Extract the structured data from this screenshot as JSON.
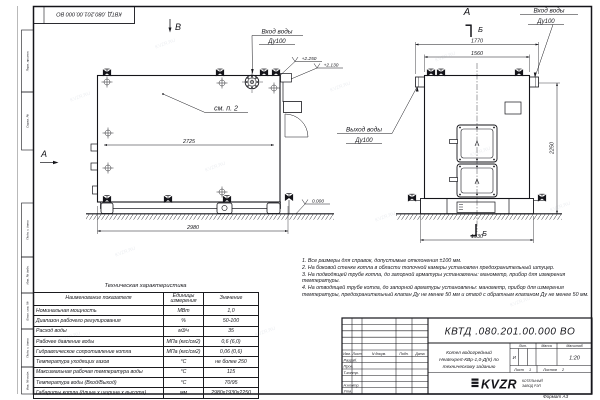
{
  "stamp_top": "КВТД .080.201.00.000 ВО",
  "watermark": "KVZR.RU",
  "margin": {
    "labels": [
      "Перв. примен.",
      "Справ. №",
      "Подп. и дата",
      "Инв. № дубл.",
      "Взам. инв. №",
      "Подп. и дата",
      "Инв. № подл."
    ]
  },
  "side": {
    "view_b": "В",
    "marker_a": "А",
    "inlet_line1": "Вход воды",
    "inlet_line2": "Ду100",
    "see_note": "см. п. 2",
    "elev_top": "+2.250",
    "elev_mid": "+2.130",
    "elev_zero": "0.000",
    "dim_inner": "2725",
    "dim_bottom": "2980"
  },
  "front": {
    "title": "А",
    "section": "Б",
    "inlet_line1": "Вход воды",
    "inlet_line2": "Ду100",
    "outlet_line1": "Выход воды",
    "outlet_line2": "Ду100",
    "dim_top_outer": "1770",
    "dim_top_inner": "1560",
    "dim_bottom": "1930",
    "dim_height": "2250"
  },
  "spec_table": {
    "title": "Техническая характеристика",
    "headers": [
      "Наименование показателя",
      "Единицы измерения",
      "Значение"
    ],
    "rows": [
      {
        "name": "Номинальная мощность",
        "unit": "МВт",
        "value": "1,0"
      },
      {
        "name": "Диапазон рабочего регулирования",
        "unit": "%",
        "value": "50-100"
      },
      {
        "name": "Расход воды",
        "unit": "м3/ч",
        "value": "35"
      },
      {
        "name": "Рабочее давление воды",
        "unit": "МПа (кгс/см2)",
        "value": "0,6 (6,0)"
      },
      {
        "name": "Гидравлическое сопротивление котла",
        "unit": "МПа (кгс/см2)",
        "value": "0,06 (0,6)"
      },
      {
        "name": "Температура уходящих газов",
        "unit": "°С",
        "value": "не более 250"
      },
      {
        "name": "Максимальная рабочая температура воды",
        "unit": "°С",
        "value": "115"
      },
      {
        "name": "Температура воды (Вход/Выход)",
        "unit": "°С",
        "value": "70/95"
      },
      {
        "name": "Габариты котла (длина х ширина х высота)",
        "unit": "мм",
        "value": "2980х1930х2250"
      }
    ]
  },
  "notes": [
    "1. Все размеры для справок, допустимые отклонения ±100 мм.",
    "2. На боковой стенке котла в области топочной камеры установлен предохранительный штуцер.",
    "3. На подводящей трубе котла, до запорной арматуры установлены: манометр, прибор для измерения температуры.",
    "4. На отводящей трубе котла, до запорной арматуры установлены: манометр, прибор для измерения температуры, предохранительный клапан Ду не менее 50 мм и отвод с обратным клапаном Ду не менее 50 мм."
  ],
  "title_block": {
    "doc_number": "КВТД .080.201.00.000 ВО",
    "name_line1": "Котел водогрейный",
    "name_line2": "Heatexpert-КВр-1,0-Д(К) по",
    "name_line3": "техническому заданию",
    "col_izm": "Изм.",
    "col_list": "Лист",
    "col_doc": "N докум.",
    "col_sign": "Подп.",
    "col_date": "Дата",
    "sig_rows": [
      "Разраб.",
      "Пров.",
      "Т.контр.",
      "",
      "Н.контр.",
      "Утв."
    ],
    "lit_label": "Лит.",
    "mass_label": "Масса",
    "scale_label": "Масштаб",
    "lit_value": "И",
    "scale_value": "1:20",
    "sheet_label": "Лист",
    "sheet_value": "1",
    "sheets_label": "Листов",
    "sheets_value": "2",
    "logo_text": "KVZR",
    "logo_sub1": "КОТЕЛЬНЫЙ",
    "logo_sub2": "ЗАВОД РЭП",
    "format_label": "Формат  А3"
  }
}
